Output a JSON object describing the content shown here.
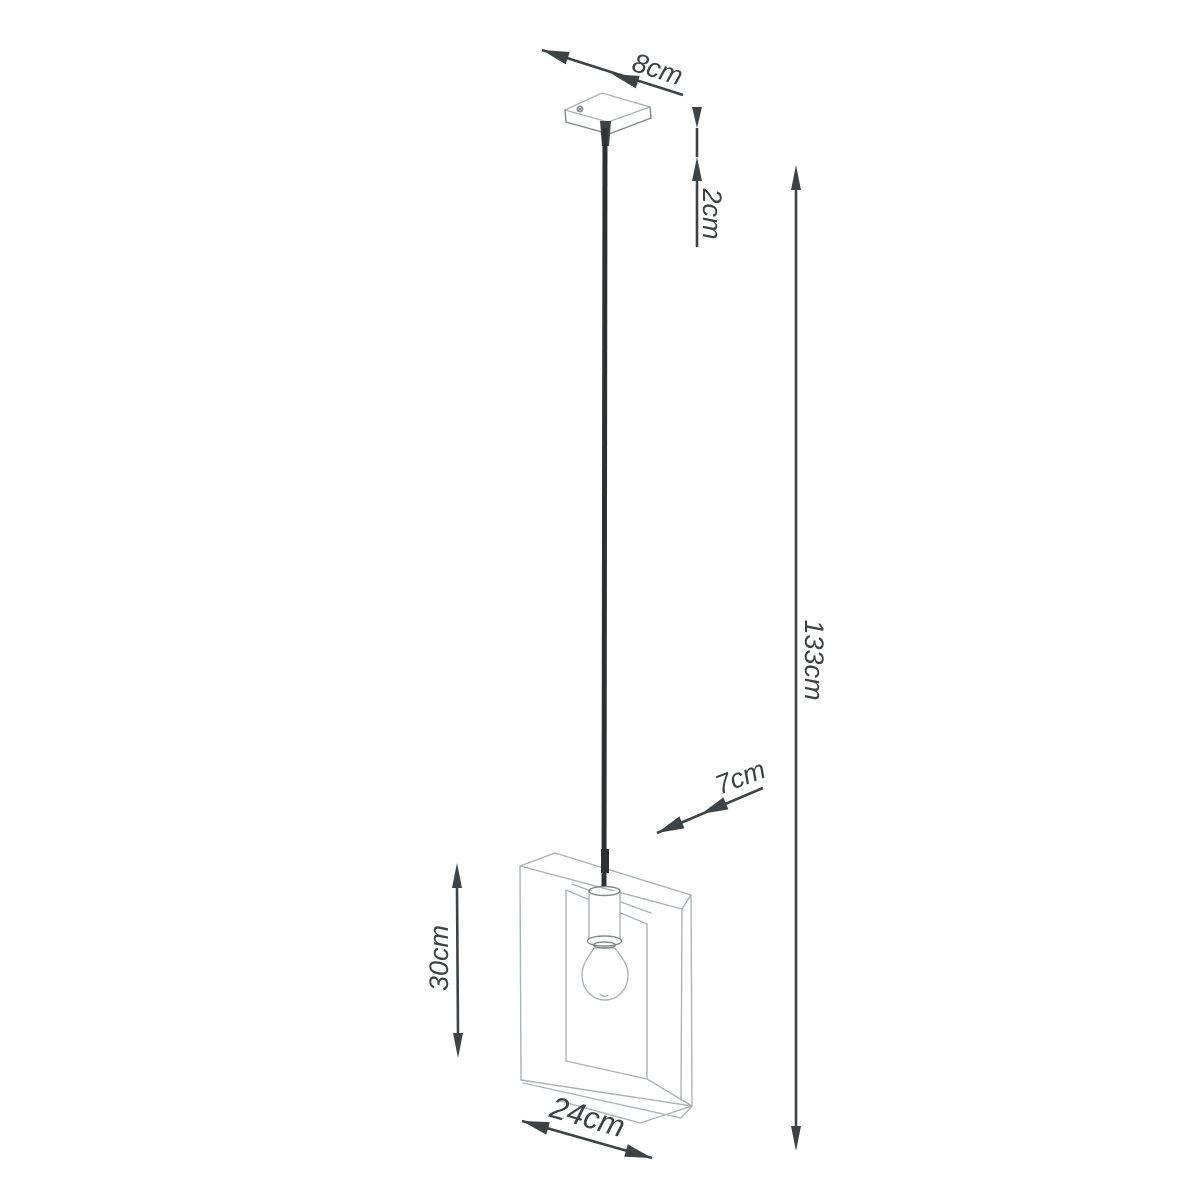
{
  "figure": {
    "type": "technical-dimension-diagram",
    "subject": "pendant lamp with square frame shade",
    "colors": {
      "background": "#ffffff",
      "dimension_ink": "#3f4245",
      "sketch_line": "#aeb3b6",
      "sketch_line_dark": "#85898c",
      "cable": "#2e3031"
    },
    "dimensions": {
      "canopy_width": {
        "label": "8cm"
      },
      "canopy_height": {
        "label": "2cm"
      },
      "overall_height": {
        "label": "133cm"
      },
      "shade_depth": {
        "label": "7cm"
      },
      "shade_height": {
        "label": "30cm"
      },
      "shade_width": {
        "label": "24cm"
      }
    }
  }
}
